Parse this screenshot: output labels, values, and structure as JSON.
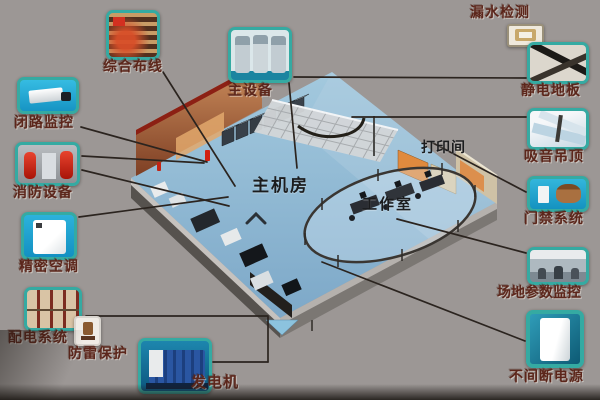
{
  "diagram": {
    "room_labels": [
      {
        "id": "main-room",
        "text": "主机房"
      },
      {
        "id": "print-room",
        "text": "打印间"
      },
      {
        "id": "work-room",
        "text": "工作室"
      }
    ],
    "components": [
      {
        "id": "integrated-cabling",
        "label": "综合布线"
      },
      {
        "id": "cctv-monitoring",
        "label": "闭路监控"
      },
      {
        "id": "fire-equipment",
        "label": "消防设备"
      },
      {
        "id": "precision-ac",
        "label": "精密空调"
      },
      {
        "id": "power-distribution",
        "label": "配电系统"
      },
      {
        "id": "lightning-protection",
        "label": "防雷保护"
      },
      {
        "id": "generator",
        "label": "发电机"
      },
      {
        "id": "main-equipment",
        "label": "主设备"
      },
      {
        "id": "leak-detection",
        "label": "漏水检测"
      },
      {
        "id": "antistatic-floor",
        "label": "静电地板"
      },
      {
        "id": "acoustic-ceiling",
        "label": "吸音吊顶"
      },
      {
        "id": "access-control",
        "label": "门禁系统"
      },
      {
        "id": "site-monitoring",
        "label": "场地参数监控"
      },
      {
        "id": "ups",
        "label": "不间断电源"
      }
    ],
    "colors": {
      "background": "#9c9795",
      "thumbnail_border": "#35aaa2",
      "thumbnail_cyan": "#1fa9d6",
      "label_text": "#5c261b",
      "room_label_text": "#1b1c1e",
      "connector_line": "#2b241f",
      "floor_blue": "#8fb9d6",
      "wall_orange": "#c9895a",
      "wall_top_red": "#8c2014"
    }
  }
}
